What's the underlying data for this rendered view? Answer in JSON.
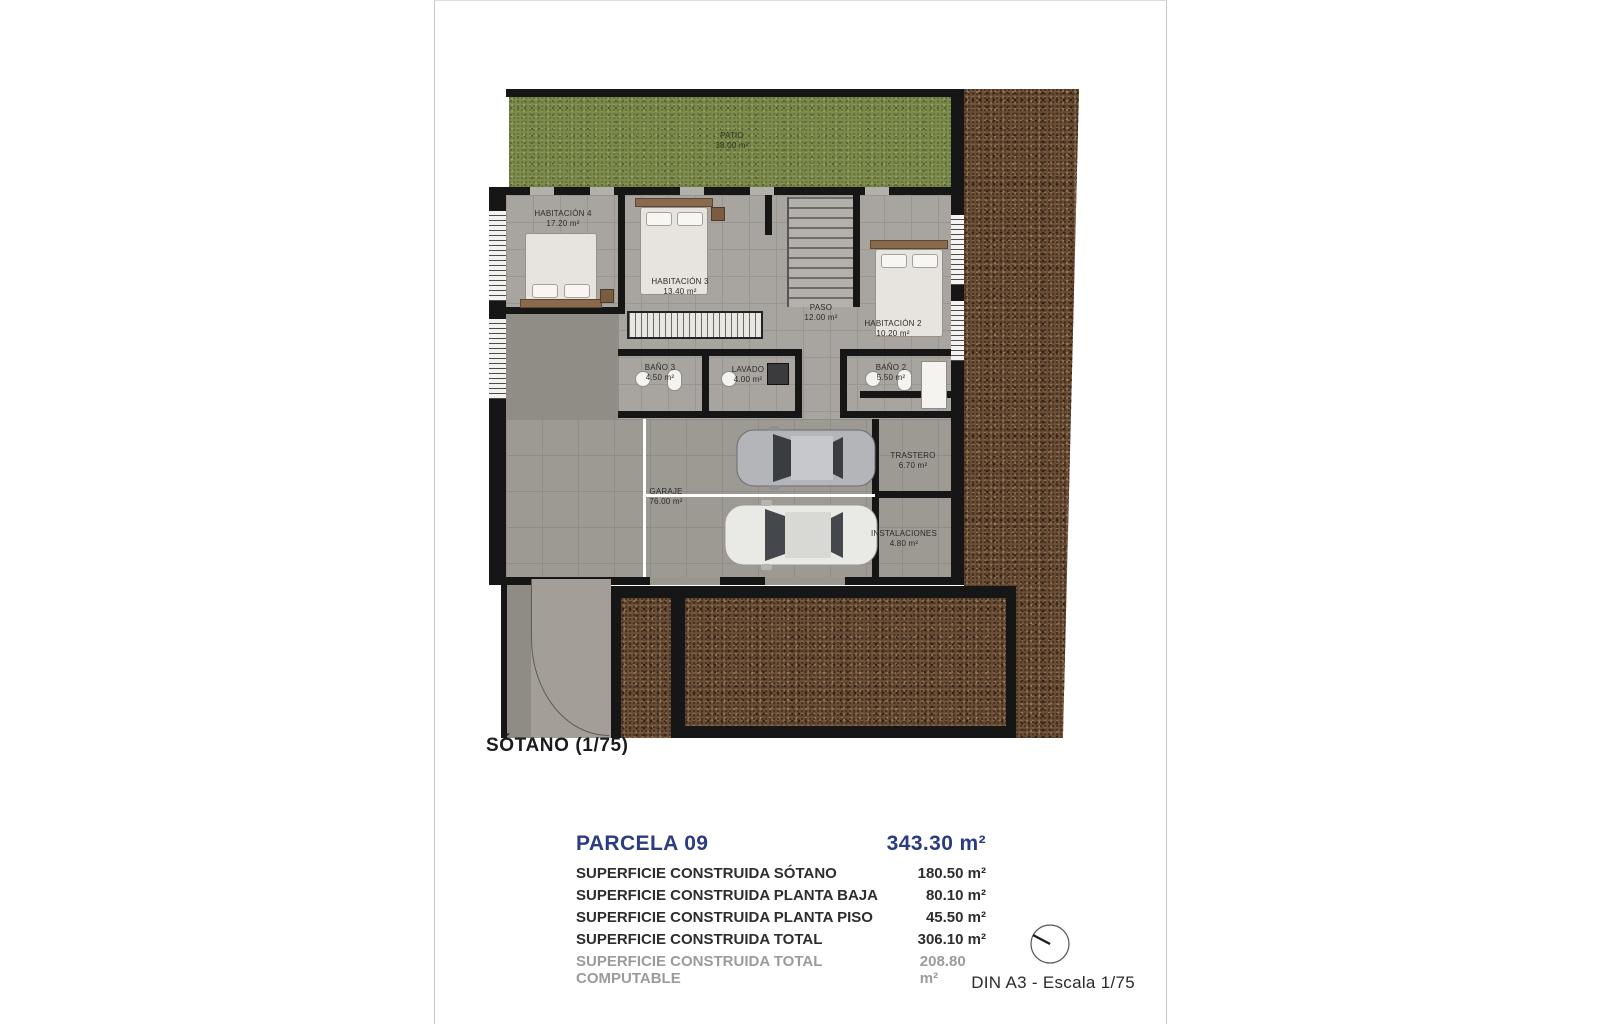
{
  "page": {
    "plan_title": "SÓTANO (1/75)",
    "footer": "DIN A3 - Escala 1/75"
  },
  "rooms": {
    "patio": {
      "name": "PATIO",
      "area": "38.00 m²"
    },
    "habitacion4": {
      "name": "HABITACIÓN 4",
      "area": "17.20 m²"
    },
    "habitacion3": {
      "name": "HABITACIÓN 3",
      "area": "13.40 m²"
    },
    "paso": {
      "name": "PASO",
      "area": "12.00 m²"
    },
    "habitacion2": {
      "name": "HABITACIÓN 2",
      "area": "10.20 m²"
    },
    "bano3": {
      "name": "BAÑO 3",
      "area": "4.50 m²"
    },
    "lavado": {
      "name": "LAVADO",
      "area": "4.00 m²"
    },
    "bano2": {
      "name": "BAÑO 2",
      "area": "5.50 m²"
    },
    "garaje": {
      "name": "GARAJE",
      "area": "76.00 m²"
    },
    "trastero": {
      "name": "TRASTERO",
      "area": "6.70 m²"
    },
    "instalaciones": {
      "name": "INSTALACIONES",
      "area": "4.80 m²"
    }
  },
  "summary": {
    "parcel_label": "PARCELA 09",
    "parcel_area": "343.30 m²",
    "rows": [
      {
        "label": "SUPERFICIE CONSTRUIDA SÓTANO",
        "value": "180.50 m²"
      },
      {
        "label": "SUPERFICIE CONSTRUIDA PLANTA BAJA",
        "value": "80.10 m²"
      },
      {
        "label": "SUPERFICIE CONSTRUIDA PLANTA PISO",
        "value": "45.50 m²"
      },
      {
        "label": "SUPERFICIE CONSTRUIDA TOTAL",
        "value": "306.10 m²"
      },
      {
        "label": "SUPERFICIE CONSTRUIDA TOTAL COMPUTABLE",
        "value": "208.80 m²"
      }
    ]
  },
  "colors": {
    "accent_navy": "#2b3c80",
    "muted_gray": "#9b9b9b",
    "grass_green": "#7d8b4e",
    "gravel_brown": "#6b4e37",
    "wall_black": "#161616"
  }
}
